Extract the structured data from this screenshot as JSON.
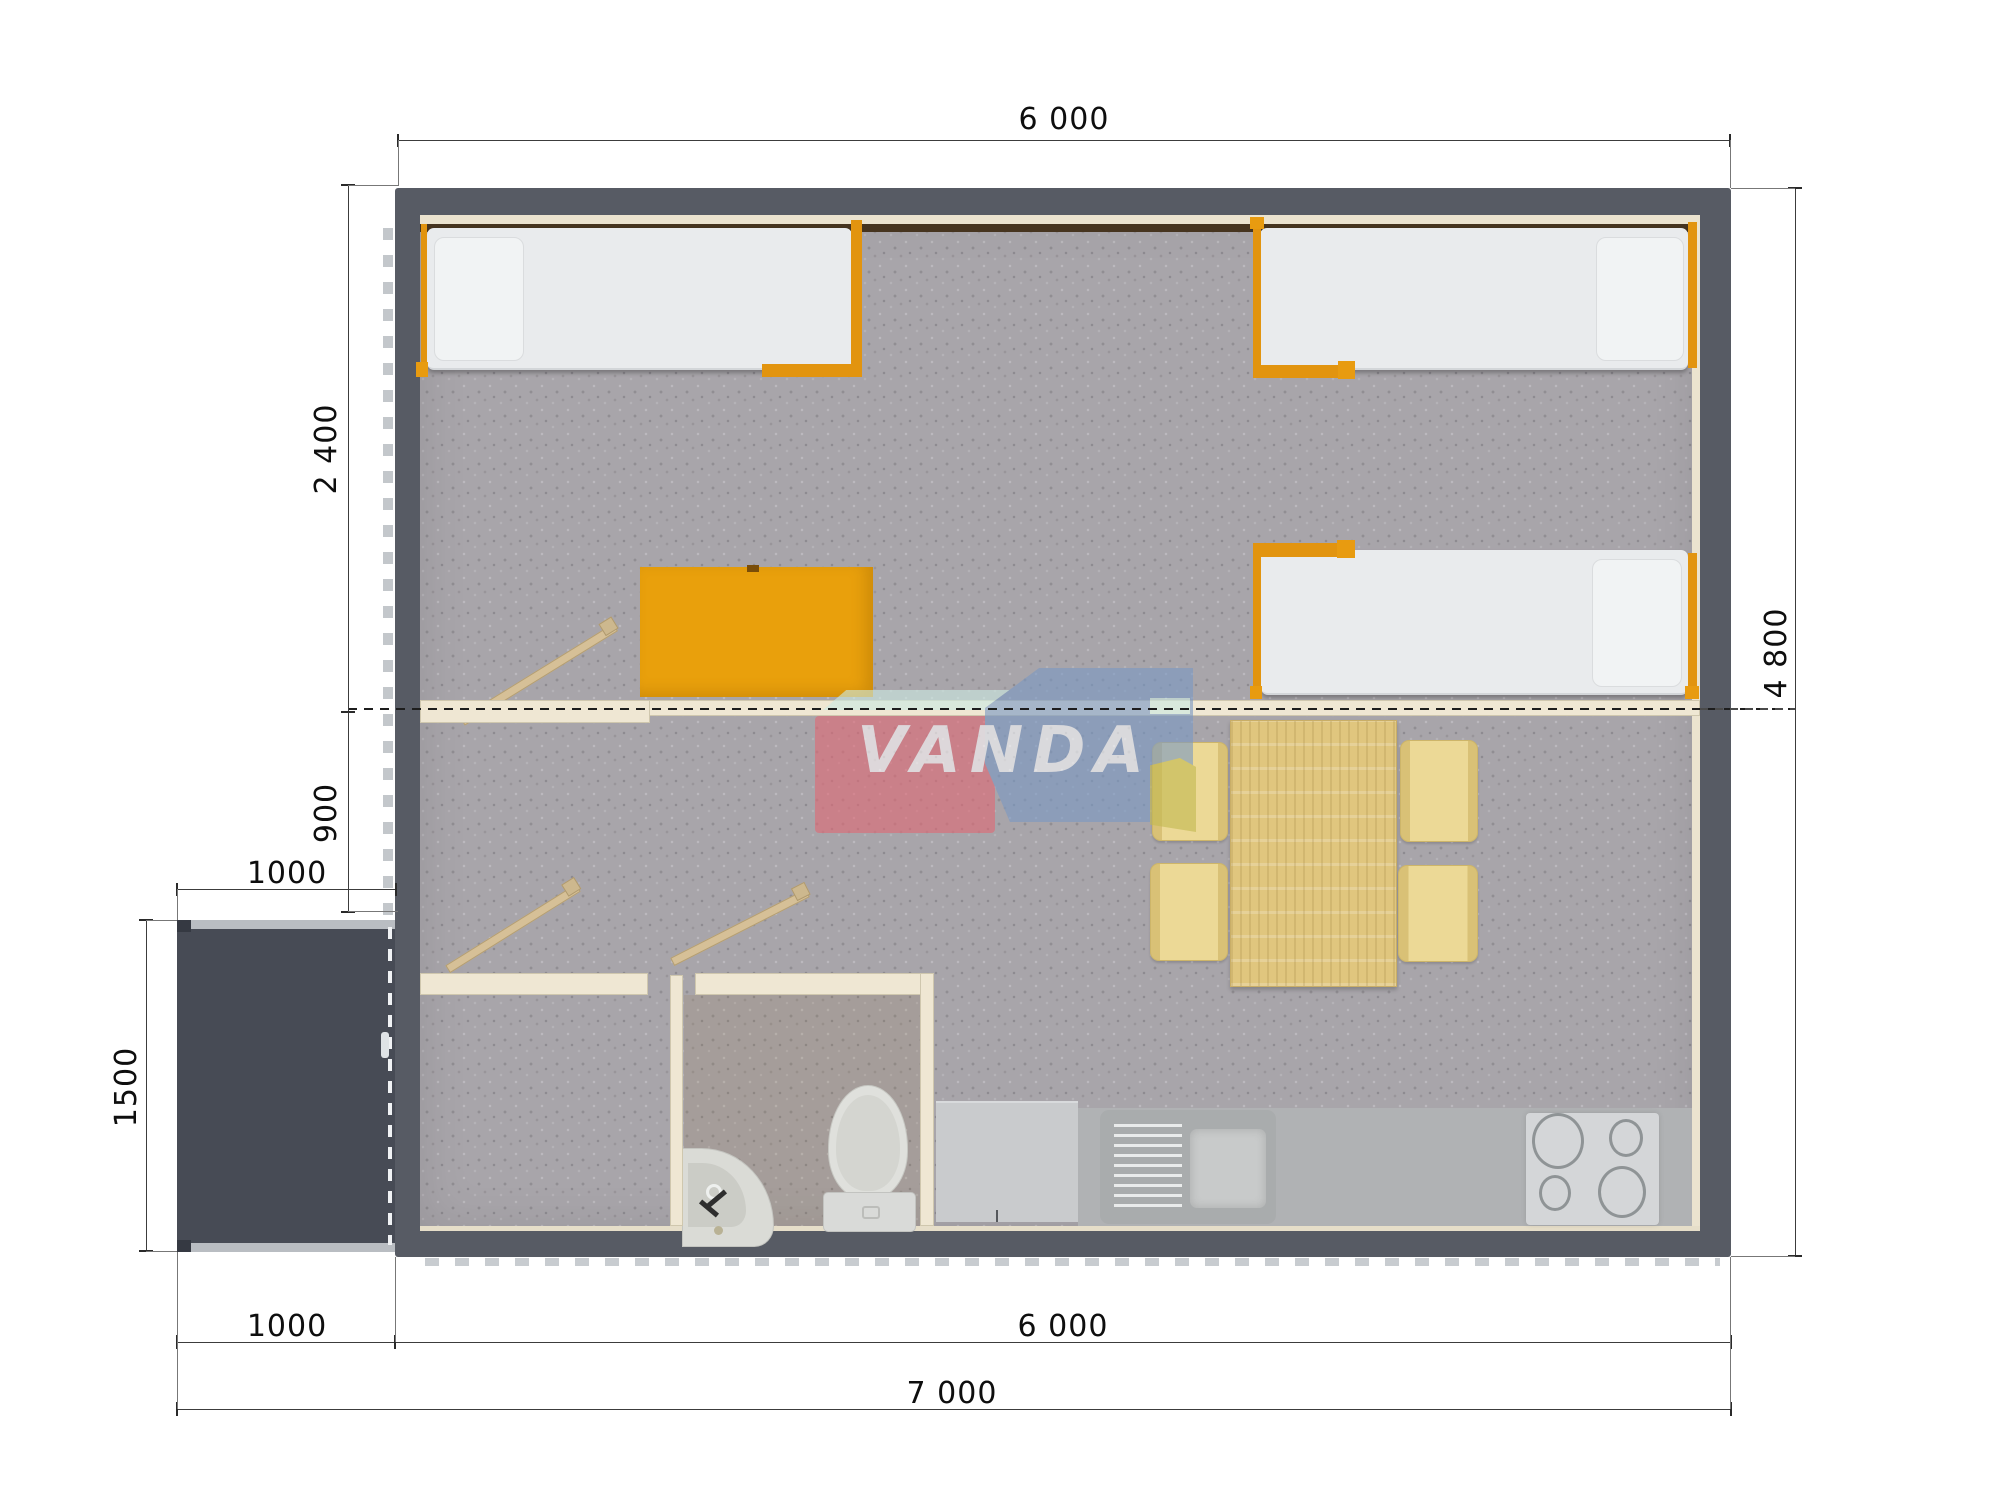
{
  "drawing": {
    "watermark_text": "VANDA",
    "dimensions": {
      "top_width": "6 000",
      "bedroom_depth": "2 400",
      "hallway_depth": "900",
      "porch_width": "1000",
      "porch_depth": "1500",
      "house_depth": "4 800",
      "bottom_porch_width": "1000",
      "bottom_house_width": "6 000",
      "total_width": "7 000"
    },
    "colors": {
      "wall": "#575b64",
      "floor_carpet": "#a8a5aa",
      "partition": "#efe7d3",
      "bed_frame_orange": "#e2940f",
      "mattress": "#e9ebed",
      "cabinet_orange": "#e9a00c",
      "table_wood": "#e0c67e",
      "chair_yellow": "#ecd996",
      "kitchen_counter": "#b0b2b4",
      "porch": "#474b55",
      "logo_pink": "#e06a76",
      "logo_blue": "#7b99c3",
      "logo_teal": "#cdeae2",
      "logo_olive": "#c3b952"
    }
  }
}
